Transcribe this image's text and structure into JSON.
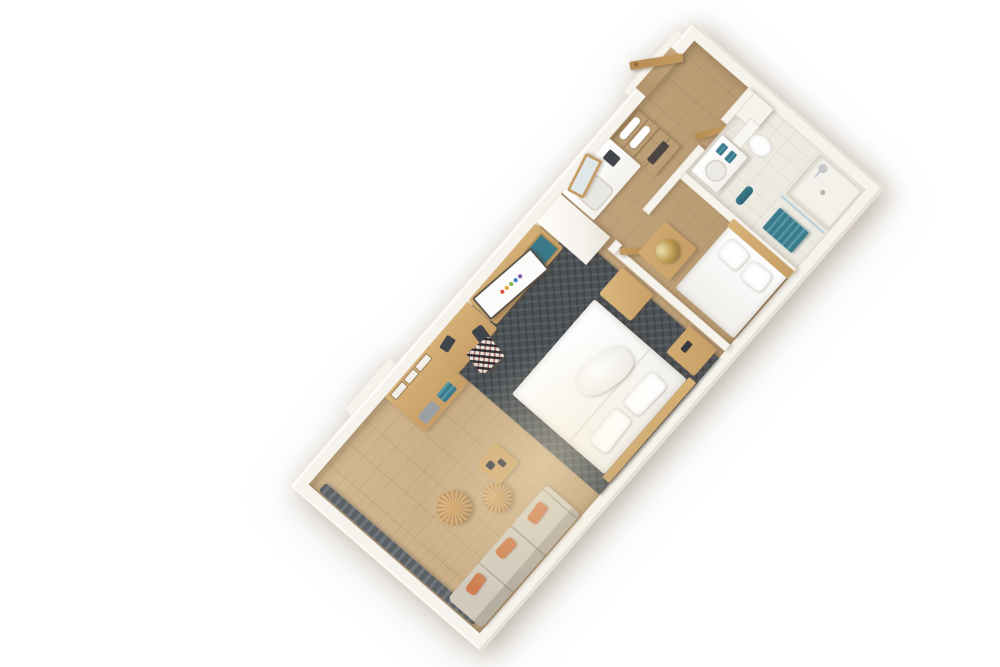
{
  "scene": {
    "title": "3D aerial floor plan render of a studio hotel suite",
    "style": "isometric 3D cutaway, white walls, wood floor, rotated diagonally on white background",
    "background": "#ffffff"
  },
  "colors": {
    "wall": "#f6f3ed",
    "wall-shade": "#e5dfd4",
    "floor-wood": "#c3a67e",
    "floor-wood-light": "#d3b992",
    "floor-wood-dark": "#b2946c",
    "rug": "#4d5357",
    "wood": "#c79f66",
    "wood-dark": "#a57f4c",
    "door-wood": "#c49a5f",
    "sofa": "#d1cabc",
    "pillow-orange": "#cf7e50",
    "pouf-wicker": "#c2945c",
    "teal": "#3b7a8a",
    "curtain": "#5c6166",
    "bedding": "#ffffff",
    "bath-tile": "#edeae1",
    "lamp-gold": "#b9974e",
    "chrome": "#c3c9cd"
  },
  "tv_logo_colors": [
    "#d94f3d",
    "#e8a33d",
    "#7ab648",
    "#3b7fc4",
    "#7e57a0"
  ],
  "rooms": [
    {
      "name": "living-area",
      "furniture": [
        "window-curtains",
        "sofa",
        "orange-accent-pillows",
        "round-wicker-pouf-large",
        "round-wicker-pouf-small",
        "wood-side-table"
      ]
    },
    {
      "name": "sleeping-area",
      "furniture": [
        "dark-herringbone-rug",
        "queen-bed-white-bedding",
        "wood-headboard",
        "nightstand",
        "luggage-bench"
      ]
    },
    {
      "name": "media-work-wall",
      "furniture": [
        "slatted-wall-panel",
        "dresser-with-art-and-bins",
        "desk",
        "patterned-stool",
        "desk-chair",
        "tv-console",
        "television-with-logo",
        "teal-accent-drawer",
        "white-wardrobe-column"
      ]
    },
    {
      "name": "kitchenette",
      "furniture": [
        "white-counter",
        "sink",
        "coffee-maker",
        "leaning-wood-frame-mirror",
        "open-towel-shelf-tower"
      ]
    },
    {
      "name": "entry-hall",
      "furniture": [
        "entry-door-wood"
      ]
    },
    {
      "name": "second-bedroom",
      "furniture": [
        "twin-bed-white-bedding",
        "wood-headboard",
        "nightstand",
        "gold-table-lamp",
        "wood-door"
      ]
    },
    {
      "name": "bathroom",
      "furniture": [
        "vanity-with-sink",
        "teal-folded-towels",
        "toilet",
        "walk-in-shower",
        "shower-head",
        "glass-partition",
        "teal-bath-mat",
        "teal-towel-roll"
      ]
    }
  ]
}
